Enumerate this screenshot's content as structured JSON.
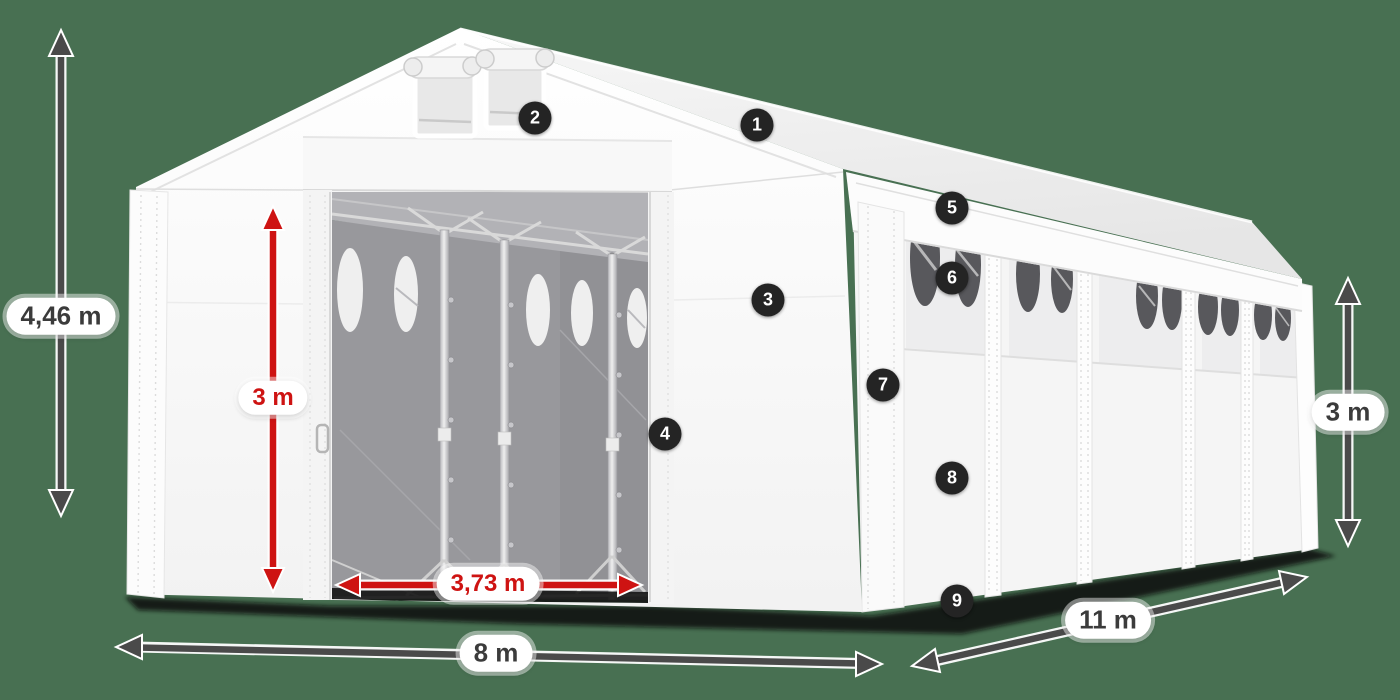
{
  "scene": {
    "background_color": "#487052",
    "accent_red": "#CE1312",
    "arrow_gray": "#4A4A4A",
    "badge_color": "#242424",
    "tent_color": "#FAFAFA"
  },
  "dimensions": {
    "total_height": "4,46 m",
    "door_height": "3 m",
    "door_width": "3,73 m",
    "front_width": "8 m",
    "side_length": "11 m",
    "side_height": "3 m"
  },
  "callouts": [
    "1",
    "2",
    "3",
    "4",
    "5",
    "6",
    "7",
    "8",
    "9"
  ]
}
